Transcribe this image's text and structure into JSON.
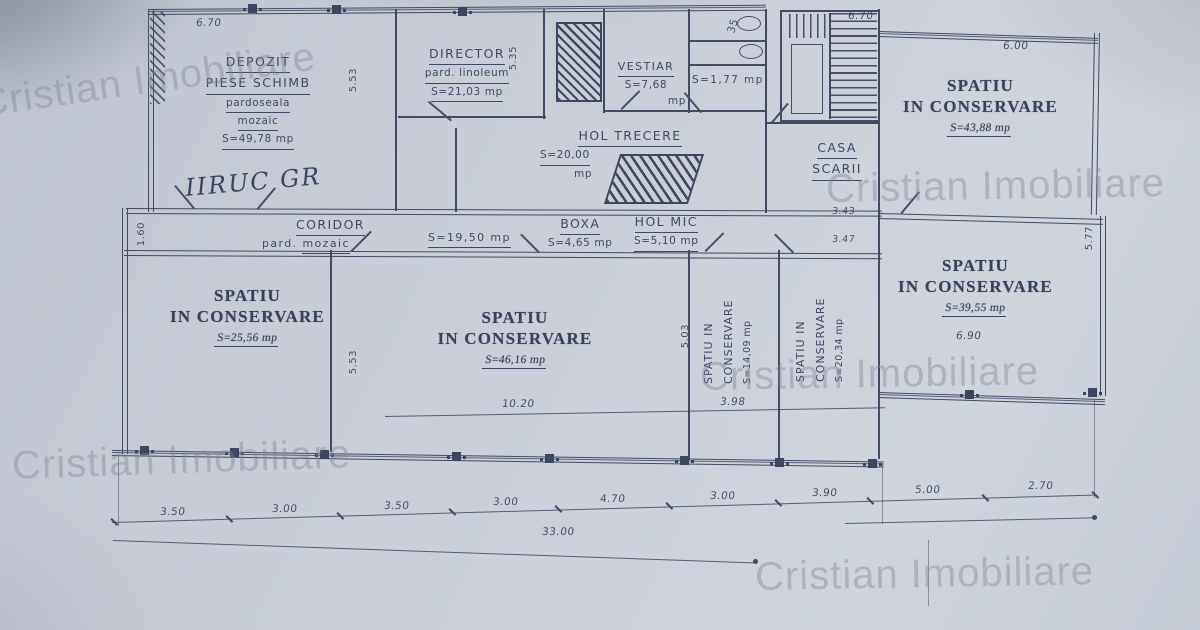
{
  "document": {
    "kind": "scanned floor plan"
  },
  "wm": {
    "text": "Cristian Imobiliare"
  },
  "rooms": {
    "depozit": {
      "name": "DEPOZIT",
      "name2": "PIESE SCHIMB",
      "floor1": "pardoseala",
      "floor2": "mozaic",
      "area": "S=49,78 mp",
      "note": "IIRUC GR"
    },
    "director": {
      "name": "DIRECTOR",
      "floor": "pard. linoleum",
      "area": "S=21,03 mp"
    },
    "vestiar": {
      "name": "VESTIAR",
      "area": "S=7,68",
      "unit": "mp"
    },
    "wc": {
      "area": "S=1,77 mp"
    },
    "hol_trecere": {
      "name": "HOL TRECERE",
      "area": "S=20,00",
      "unit": "mp"
    },
    "casa_scarii": {
      "name": "CASA",
      "name2": "SCARII"
    },
    "coridor": {
      "name": "CORIDOR",
      "floor_prefix": "pard.",
      "floor_name": "mozaic",
      "area": "S=19,50 mp"
    },
    "boxa": {
      "name": "BOXA",
      "area": "S=4,65 mp"
    },
    "hol_mic": {
      "name": "HOL MIC",
      "area": "S=5,10 mp"
    },
    "cons_tr": {
      "name": "SPATIU",
      "name2": "IN CONSERVARE",
      "area": "S=43,88 mp"
    },
    "cons_left": {
      "name": "SPATIU",
      "name2": "IN CONSERVARE",
      "area": "S=25,56 mp"
    },
    "cons_center": {
      "name": "SPATIU",
      "name2": "IN CONSERVARE",
      "area": "S=46,16 mp"
    },
    "cons_right": {
      "name": "SPATIU",
      "name2": "IN CONSERVARE",
      "area": "S=39,55 mp"
    },
    "cons_n1": {
      "name": "SPATIU IN",
      "name2": "CONSERVARE",
      "area": "S=14,09 mp"
    },
    "cons_n2": {
      "name": "SPATIU IN",
      "name2": "CONSERVARE",
      "area": "S=20,34 mp"
    }
  },
  "dims": {
    "bottom_chain": [
      "3.50",
      "3.00",
      "3.50",
      "3.00",
      "4.70",
      "3.00",
      "3.90",
      "5.00",
      "2.70"
    ],
    "total": "33.00",
    "top_left": "6.70",
    "top_right": "6.70",
    "top_right_block": "6.00",
    "stairs_note": "35",
    "center_width": "10.20",
    "narrow_width": "3.98",
    "right_inner": "6.90",
    "casa_a": "3.43",
    "casa_b": "3.47",
    "v_left": "1.60",
    "v_depozit": "5.53",
    "v_director": "5.35",
    "v_center": "5.53",
    "v_narrow": "5.03",
    "v_right": "5.77"
  }
}
